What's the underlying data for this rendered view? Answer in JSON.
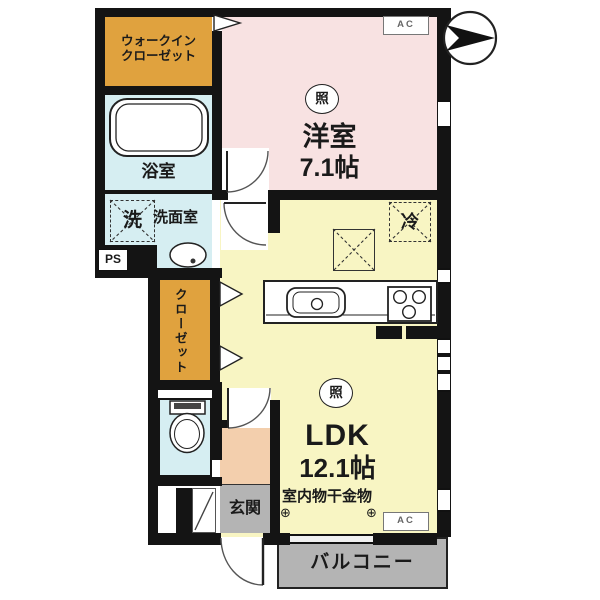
{
  "plan": {
    "title": "apartment-floor-plan",
    "labels": {
      "wic_line1": "ウォークイン",
      "wic_line2": "クローゼット",
      "bath": "浴室",
      "washer": "洗",
      "washroom": "洗面室",
      "ps": "PS",
      "closet": "クローゼット",
      "western_room": "洋室",
      "western_room_size": "7.1帖",
      "light": "照",
      "fridge": "冷",
      "ldk": "LDK",
      "ldk_size": "12.1帖",
      "laundry_hardware": "室内物干金物",
      "anchor_left": "⊕",
      "anchor_right": "⊕",
      "entrance": "玄関",
      "balcony": "バルコニー",
      "ac_top": "AC",
      "ac_bottom": "AC"
    },
    "colors": {
      "wall": "#141414",
      "western_room": "#f8e2e2",
      "ldk": "#f8f5c3",
      "closet_orange": "#e0a23e",
      "wet_area_cyan": "#d6eef2",
      "entrance_hall_peach": "#f3cfad",
      "entrance_gray": "#b4b4b4",
      "balcony_gray": "#b4b4b4"
    }
  }
}
